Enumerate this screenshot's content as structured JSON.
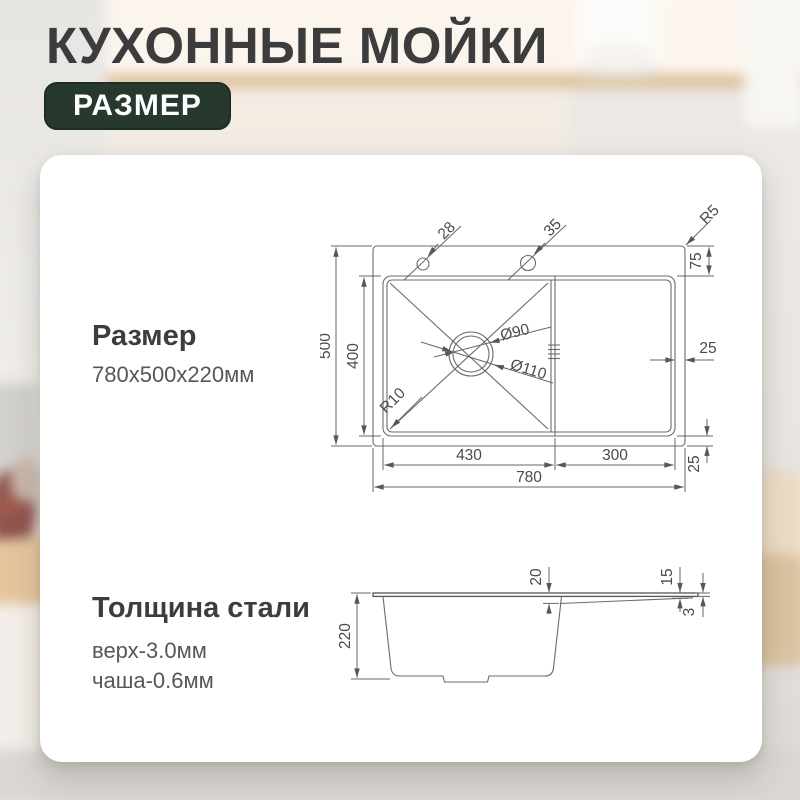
{
  "header": {
    "title": "КУХОННЫЕ МОЙКИ",
    "badge": "РАЗМЕР"
  },
  "sections": {
    "size": {
      "heading": "Размер",
      "value": "780x500x220мм"
    },
    "thickness": {
      "heading": "Толщина стали",
      "lines": [
        "верх-3.0мм",
        "чаша-0.6мм"
      ]
    }
  },
  "top_view": {
    "width_total": "780",
    "width_bowl": "430",
    "width_drainboard": "300",
    "height_total": "500",
    "height_bowl": "400",
    "deck_height": "75",
    "margin_right": "25",
    "margin_bottom": "25",
    "hole_small": "28",
    "hole_large": "35",
    "corner_radius": "R5",
    "bowl_corner_radius": "R10",
    "drain_inner": "Ø90",
    "drain_outer": "Ø110"
  },
  "side_view": {
    "depth": "220",
    "drop_bowl_side": "20",
    "drop_right_side": "15",
    "top_steel": "3"
  },
  "colors": {
    "badge_bg": "#27382f",
    "title_text": "#3c3c3c",
    "drawing_line": "#6b6b6b"
  }
}
